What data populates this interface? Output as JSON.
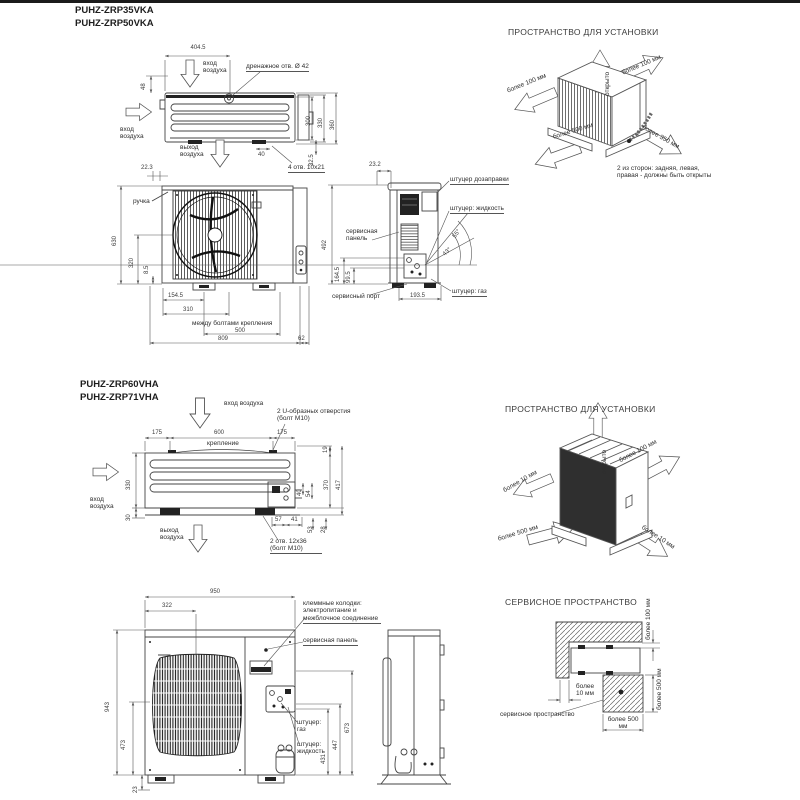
{
  "s1": {
    "model1": "PUHZ-ZRP35VKA",
    "model2": "PUHZ-ZRP50VKA",
    "tv": {
      "w404": "404.5",
      "d48": "48",
      "air_in_top": "вход воздуха",
      "air_in_left": "вход воздуха",
      "air_out": "выход воздуха",
      "drain": "дренажное отв. Ø 42",
      "d300": "300",
      "d330": "330",
      "d360": "360",
      "d40": "40",
      "d325": "32.5",
      "holes": "4 отв. 10х21",
      "d223": "22.3"
    },
    "fv": {
      "handle": "ручка",
      "d630": "630",
      "d320": "320",
      "d85": "8.5",
      "d1545": "154.5",
      "d310": "310",
      "bolts": "между болтами крепления",
      "d500": "500",
      "d809": "809",
      "d62": "62"
    },
    "sv": {
      "d232": "23.2",
      "refill": "штуцер дозаправки",
      "liquid": "штуцер: жидкость",
      "panel": "сервисная панель",
      "d492": "492",
      "d1645": "164.5",
      "d995": "99.5",
      "port": "сервисный порт",
      "d1935": "193.5",
      "gas": "штуцер: газ",
      "a55": "55°",
      "a43": "43°"
    },
    "inst": {
      "title": "ПРОСТРАНСТВО ДЛЯ УСТАНОВКИ",
      "open": "открыто",
      "m100r": "более 100 мм",
      "m100l": "более 100 мм",
      "m500": "более 500 мм",
      "m350": "более 350 мм",
      "note": "2 из сторон: задняя, левая, правая  - должны быть открыты"
    }
  },
  "s2": {
    "model1": "PUHZ-ZRP60VHA",
    "model2": "PUHZ-ZRP71VHA",
    "tv": {
      "air_in_top": "вход воздуха",
      "uholes": "2 U-образных отверстия (болт М10)",
      "d175a": "175",
      "d600": "600",
      "mount": "крепление",
      "d175b": "175",
      "d19": "19",
      "air_in_left": "вход воздуха",
      "d330": "330",
      "d30": "30",
      "d40": "40",
      "d54": "54",
      "d370": "370",
      "d417": "417",
      "d57": "57",
      "d41": "41",
      "d53": "53",
      "d28": "28",
      "air_out": "выход воздуха",
      "holes": "2 отв. 12х36 (болт М10)"
    },
    "inst": {
      "title": "ПРОСТРАНСТВО ДЛЯ УСТАНОВКИ",
      "open": "открыто",
      "m100": "более 100 мм",
      "m10l": "более 10 мм",
      "m500": "более 500 мм",
      "m10r": "более 10 мм"
    },
    "fv": {
      "d950": "950",
      "d322": "322",
      "terminal": "клеммные колодки: электропитание и межблочное соединение",
      "panel": "сервисная панель",
      "d943": "943",
      "d473": "473",
      "d23": "23",
      "gas": "штуцер: газ",
      "liquid": "штуцер: жидкость",
      "d673": "673",
      "d447": "447",
      "d431": "431"
    },
    "svc": {
      "title": "СЕРВИСНОЕ ПРОСТРАНСТВО",
      "m100": "более 100 мм",
      "m10": "более 10 мм",
      "m500r": "более 500 мм",
      "m500b": "более 500 мм",
      "label": "сервисное пространство"
    }
  }
}
